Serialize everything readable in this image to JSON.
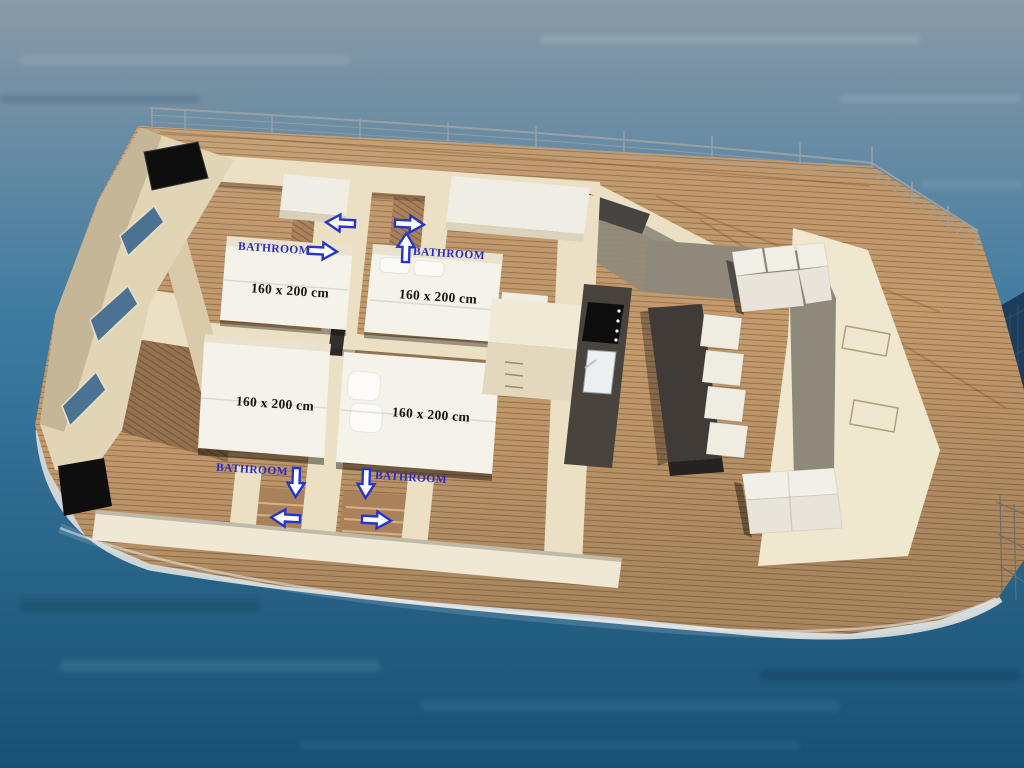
{
  "scene": {
    "description": "3D aerial rendering of a catamaran yacht interior deck plan floating on blue water",
    "colors": {
      "water_top": "#8a9aa6",
      "water_mid": "#3d7aa1",
      "water_bottom": "#175173",
      "deck_wood": "#c49b6d",
      "plank_line": "#5a3a1e",
      "interior_wood": "#a9825b",
      "wall_cream": "#ece0c4",
      "wall_beige_dark": "#c6b698",
      "bottom_wall": "#efe8d4",
      "bed_white": "#f5f2ea",
      "furniture_white": "#f0ede4",
      "dark_wood_table": "#403b37",
      "counter_dark": "#49433e",
      "tv_black": "#0e0e0e",
      "window_blue": "#4c7292",
      "gray_floor": "#8f897c",
      "hull_stripe": "#cfd4d6",
      "railing_gray": "#99a0a5",
      "trampoline_navy": "#1d3b5c",
      "label_blue": "#2a2ec0",
      "label_black": "#151515",
      "arrow_fill": "#ffffff",
      "arrow_stroke": "#2536c8"
    }
  },
  "cabins": {
    "beds": [
      {
        "label": "160 x 200 cm"
      },
      {
        "label": "160 x 200 cm"
      },
      {
        "label": "160 x 200 cm"
      },
      {
        "label": "160 x 200 cm"
      }
    ],
    "bathrooms": [
      {
        "label": "BATHROOM",
        "arrows": [
          "left",
          "right"
        ]
      },
      {
        "label": "BATHROOM",
        "arrows": [
          "right",
          "up"
        ]
      },
      {
        "label": "BATHROOM",
        "arrows": [
          "down",
          "left"
        ]
      },
      {
        "label": "BATHROOM",
        "arrows": [
          "down",
          "right"
        ]
      }
    ]
  }
}
